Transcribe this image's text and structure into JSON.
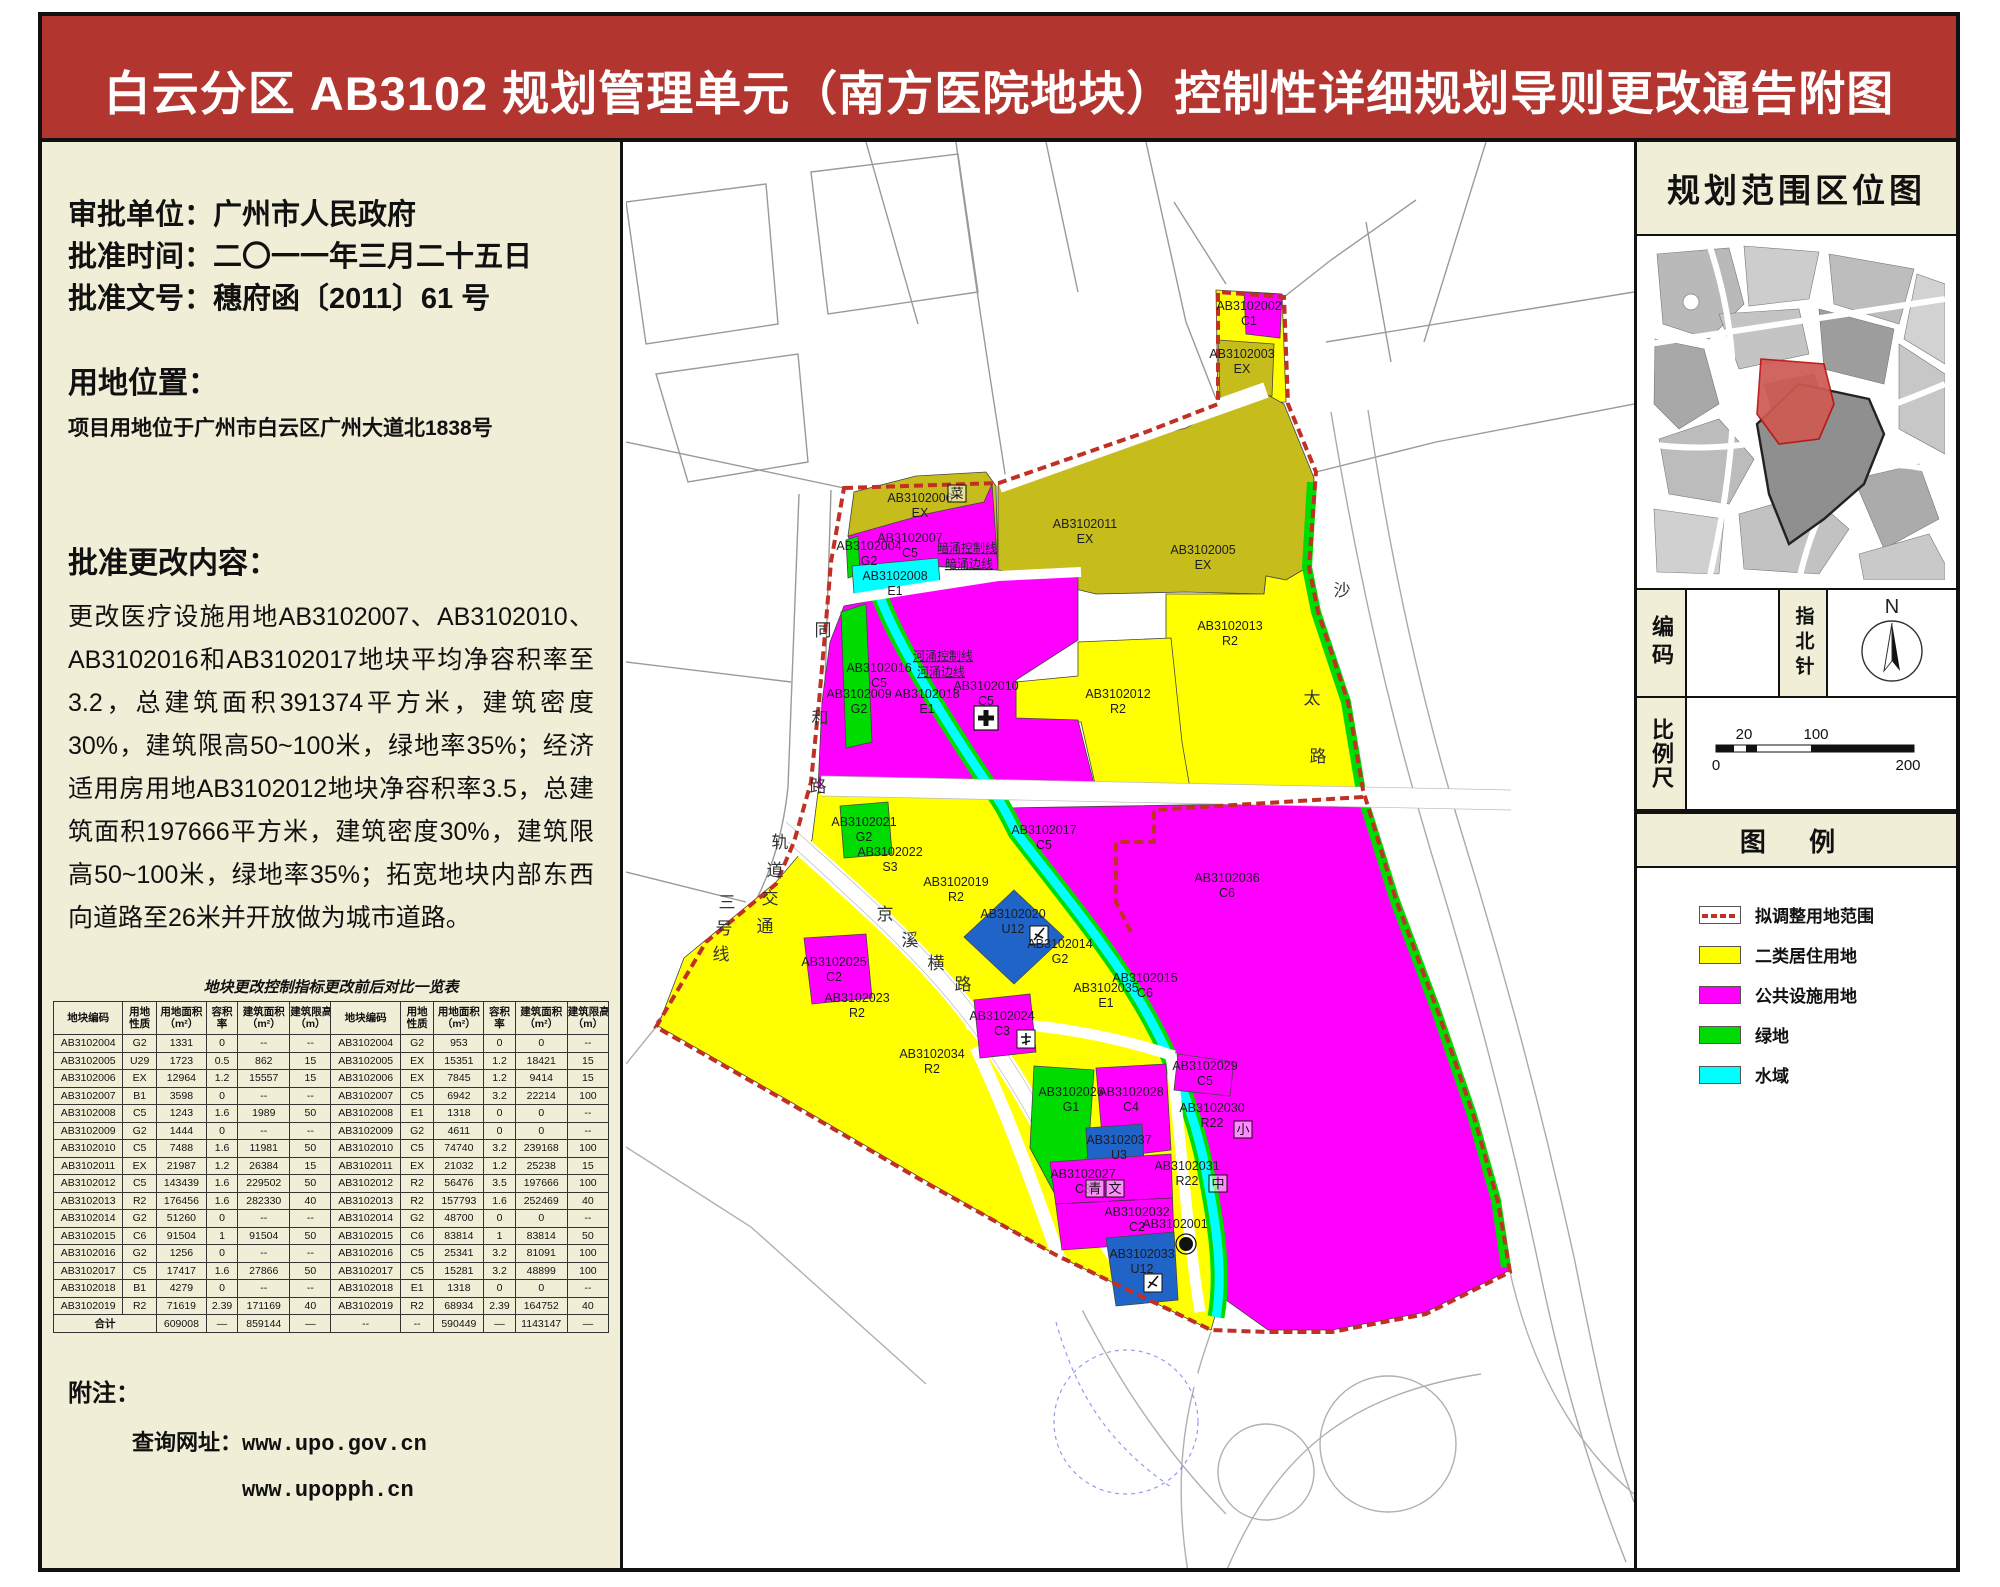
{
  "title": "白云分区 AB3102 规划管理单元（南方医院地块）控制性详细规划导则更改通告附图",
  "colors": {
    "header": "#B23530",
    "panel": "#F0EED6",
    "boundary": "#C03025",
    "residential": "#FFFF00",
    "public_facility": "#FF00FF",
    "green_space": "#00DC00",
    "water": "#00FFFF",
    "olive_existing": "#C6BD1C",
    "utility_blue": "#2064C8"
  },
  "info": {
    "line1": "审批单位：广州市人民政府",
    "line2": "批准时间：二〇一一年三月二十五日",
    "line3": "批准文号：穗府函〔2011〕61 号",
    "location_heading": "用地位置：",
    "location_text": "项目用地位于广州市白云区广州大道北1838号",
    "changes_heading": "批准更改内容：",
    "changes_text": "更改医疗设施用地AB3102007、AB3102010、AB3102016和AB3102017地块平均净容积率至3.2，总建筑面积391374平方米，建筑密度30%，建筑限高50~100米，绿地率35%；经济适用房用地AB3102012地块净容积率3.5，总建筑面积197666平方米，建筑密度30%，建筑限高50~100米，绿地率35%；拓宽地块内部东西向道路至26米并开放做为城市道路。"
  },
  "table": {
    "title": "地块更改控制指标更改前后对比一览表",
    "headers": [
      "地块编码",
      "用地 性质",
      "用地面积 （m²）",
      "容积 率",
      "建筑面积 （m²）",
      "建筑限高 （m）"
    ],
    "rows": [
      {
        "before": [
          "AB3102004",
          "G2",
          "1331",
          "0",
          "--",
          "--"
        ],
        "after": [
          "AB3102004",
          "G2",
          "953",
          "0",
          "0",
          "--"
        ]
      },
      {
        "before": [
          "AB3102005",
          "U29",
          "1723",
          "0.5",
          "862",
          "15"
        ],
        "after": [
          "AB3102005",
          "EX",
          "15351",
          "1.2",
          "18421",
          "15"
        ]
      },
      {
        "before": [
          "AB3102006",
          "EX",
          "12964",
          "1.2",
          "15557",
          "15"
        ],
        "after": [
          "AB3102006",
          "EX",
          "7845",
          "1.2",
          "9414",
          "15"
        ]
      },
      {
        "before": [
          "AB3102007",
          "B1",
          "3598",
          "0",
          "--",
          "--"
        ],
        "after": [
          "AB3102007",
          "C5",
          "6942",
          "3.2",
          "22214",
          "100"
        ]
      },
      {
        "before": [
          "AB3102008",
          "C5",
          "1243",
          "1.6",
          "1989",
          "50"
        ],
        "after": [
          "AB3102008",
          "E1",
          "1318",
          "0",
          "0",
          "--"
        ]
      },
      {
        "before": [
          "AB3102009",
          "G2",
          "1444",
          "0",
          "--",
          "--"
        ],
        "after": [
          "AB3102009",
          "G2",
          "4611",
          "0",
          "0",
          "--"
        ]
      },
      {
        "before": [
          "AB3102010",
          "C5",
          "7488",
          "1.6",
          "11981",
          "50"
        ],
        "after": [
          "AB3102010",
          "C5",
          "74740",
          "3.2",
          "239168",
          "100"
        ]
      },
      {
        "before": [
          "AB3102011",
          "EX",
          "21987",
          "1.2",
          "26384",
          "15"
        ],
        "after": [
          "AB3102011",
          "EX",
          "21032",
          "1.2",
          "25238",
          "15"
        ]
      },
      {
        "before": [
          "AB3102012",
          "C5",
          "143439",
          "1.6",
          "229502",
          "50"
        ],
        "after": [
          "AB3102012",
          "R2",
          "56476",
          "3.5",
          "197666",
          "100"
        ]
      },
      {
        "before": [
          "AB3102013",
          "R2",
          "176456",
          "1.6",
          "282330",
          "40"
        ],
        "after": [
          "AB3102013",
          "R2",
          "157793",
          "1.6",
          "252469",
          "40"
        ]
      },
      {
        "before": [
          "AB3102014",
          "G2",
          "51260",
          "0",
          "--",
          "--"
        ],
        "after": [
          "AB3102014",
          "G2",
          "48700",
          "0",
          "0",
          "--"
        ]
      },
      {
        "before": [
          "AB3102015",
          "C6",
          "91504",
          "1",
          "91504",
          "50"
        ],
        "after": [
          "AB3102015",
          "C6",
          "83814",
          "1",
          "83814",
          "50"
        ]
      },
      {
        "before": [
          "AB3102016",
          "G2",
          "1256",
          "0",
          "--",
          "--"
        ],
        "after": [
          "AB3102016",
          "C5",
          "25341",
          "3.2",
          "81091",
          "100"
        ]
      },
      {
        "before": [
          "AB3102017",
          "C5",
          "17417",
          "1.6",
          "27866",
          "50"
        ],
        "after": [
          "AB3102017",
          "C5",
          "15281",
          "3.2",
          "48899",
          "100"
        ]
      },
      {
        "before": [
          "AB3102018",
          "B1",
          "4279",
          "0",
          "--",
          "--"
        ],
        "after": [
          "AB3102018",
          "E1",
          "1318",
          "0",
          "0",
          "--"
        ]
      },
      {
        "before": [
          "AB3102019",
          "R2",
          "71619",
          "2.39",
          "171169",
          "40"
        ],
        "after": [
          "AB3102019",
          "R2",
          "68934",
          "2.39",
          "164752",
          "40"
        ]
      }
    ],
    "totals": {
      "label": "合计",
      "before": [
        "609008",
        "—",
        "859144",
        "—"
      ],
      "after": [
        "--",
        "--",
        "590449",
        "—",
        "1143147",
        "—"
      ]
    }
  },
  "notes": {
    "label": "附注：",
    "query_label": "查询网址：",
    "urls": [
      "www.upo.gov.cn",
      "www.upopph.cn"
    ]
  },
  "right_panel": {
    "location_title": "规划范围区位图",
    "code_label": "编码",
    "compass_label": "指北针",
    "compass_n": "N",
    "scale_label": "比例尺",
    "scale_ticks_top": [
      "20",
      "100"
    ],
    "scale_ticks_bottom": [
      "0",
      "200"
    ],
    "legend_title": "图  例",
    "legend": [
      {
        "label": "拟调整用地范围",
        "type": "red-dash"
      },
      {
        "label": "二类居住用地",
        "type": "fill",
        "color": "#FFFF00"
      },
      {
        "label": "公共设施用地",
        "type": "fill",
        "color": "#FF00FF"
      },
      {
        "label": "绿地",
        "type": "fill",
        "color": "#00DC00"
      },
      {
        "label": "水域",
        "type": "fill",
        "color": "#00FFFF"
      }
    ]
  },
  "map": {
    "parcels": [
      {
        "code": "AB3102002",
        "use": "C1"
      },
      {
        "code": "AB3102003",
        "use": "EX"
      },
      {
        "code": "AB3102004",
        "use": "G2"
      },
      {
        "code": "AB3102005",
        "use": "EX"
      },
      {
        "code": "AB3102006",
        "use": "EX"
      },
      {
        "code": "AB3102007",
        "use": "C5"
      },
      {
        "code": "AB3102008",
        "use": "E1"
      },
      {
        "code": "AB3102009",
        "use": "G2"
      },
      {
        "code": "AB3102010",
        "use": "C5"
      },
      {
        "code": "AB3102011",
        "use": "EX"
      },
      {
        "code": "AB3102012",
        "use": "R2"
      },
      {
        "code": "AB3102013",
        "use": "R2"
      },
      {
        "code": "AB3102014",
        "use": "G2"
      },
      {
        "code": "AB3102015",
        "use": "C6"
      },
      {
        "code": "AB3102016",
        "use": "C5"
      },
      {
        "code": "AB3102017",
        "use": "C5"
      },
      {
        "code": "AB3102018",
        "use": "E1"
      },
      {
        "code": "AB3102019",
        "use": "R2"
      },
      {
        "code": "AB3102020",
        "use": "U12"
      },
      {
        "code": "AB3102021",
        "use": "G2"
      },
      {
        "code": "AB3102022",
        "use": "S3"
      },
      {
        "code": "AB3102023",
        "use": "R2"
      },
      {
        "code": "AB3102024",
        "use": "C3"
      },
      {
        "code": "AB3102025",
        "use": "C2"
      },
      {
        "code": "AB3102026",
        "use": "G1"
      },
      {
        "code": "AB3102027",
        "use": "C3"
      },
      {
        "code": "AB3102028",
        "use": "C4"
      },
      {
        "code": "AB3102029",
        "use": "C5"
      },
      {
        "code": "AB3102030",
        "use": "R22"
      },
      {
        "code": "AB3102031",
        "use": "R22"
      },
      {
        "code": "AB3102032",
        "use": "C2"
      },
      {
        "code": "AB3102033",
        "use": "U12"
      },
      {
        "code": "AB3102034",
        "use": "R2"
      },
      {
        "code": "AB3102035",
        "use": "E1"
      },
      {
        "code": "AB3102036",
        "use": "C6"
      },
      {
        "code": "AB3102037",
        "use": "U3"
      },
      {
        "code": "AB3102001",
        "use": ""
      }
    ],
    "roads": [
      "同和路",
      "轨道交通三号线",
      "沙太路",
      "京溪横路"
    ],
    "annotations": [
      "暗涌控制线",
      "暗涌边线",
      "河涌控制线",
      "河涌边线"
    ],
    "badges": [
      "菜",
      "小",
      "中",
      "青",
      "文"
    ]
  }
}
